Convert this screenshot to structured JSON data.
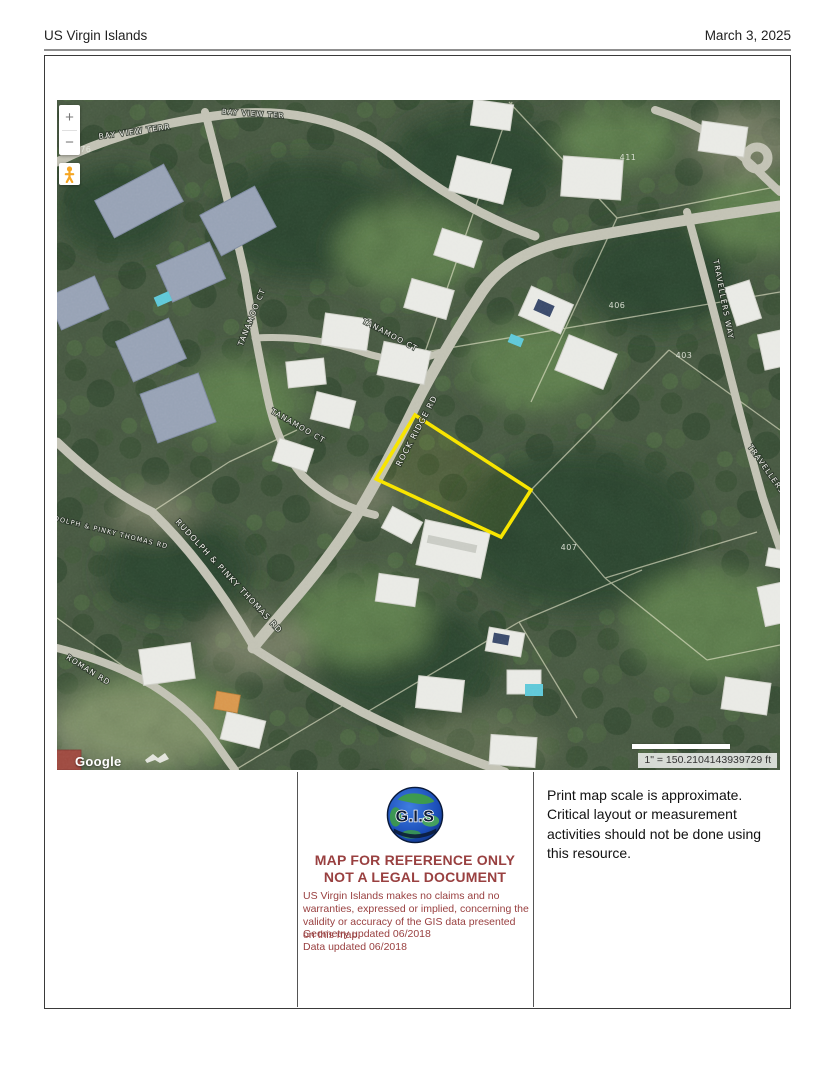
{
  "header": {
    "title": "US Virgin Islands",
    "date": "March 3, 2025"
  },
  "map": {
    "zoom_in_label": "+",
    "zoom_out_label": "−",
    "pegman_icon": "street-view-pegman",
    "attribution": "Google",
    "scale_text": "1\" = 150.2104143939729 ft",
    "highlight_color": "#f8e400",
    "street_labels": [
      {
        "text": "BAY VIEW TERR",
        "x": 78,
        "y": 34,
        "rot": -8,
        "size": 7.5
      },
      {
        "text": "BAY VIEW TER",
        "x": 196,
        "y": 16,
        "rot": 4,
        "size": 7
      },
      {
        "text": "TANAMOO CT",
        "x": 197,
        "y": 218,
        "rot": -68,
        "size": 7.5
      },
      {
        "text": "TANAMOO CT",
        "x": 332,
        "y": 237,
        "rot": 28,
        "size": 7.5
      },
      {
        "text": "TANAMOO CT",
        "x": 240,
        "y": 328,
        "rot": 30,
        "size": 7.5
      },
      {
        "text": "ROCK RIDGE RD",
        "x": 362,
        "y": 332,
        "rot": -62,
        "size": 8
      },
      {
        "text": "RUDOLPH & PINKY THOMAS RD",
        "x": 170,
        "y": 478,
        "rot": 47,
        "size": 8
      },
      {
        "text": "RUDOLPH & PINKY THOMAS RD",
        "x": 48,
        "y": 433,
        "rot": 14,
        "size": 6.5
      },
      {
        "text": "ROMAN RD",
        "x": 30,
        "y": 572,
        "rot": 32,
        "size": 7.5
      },
      {
        "text": "TRAVELLERS WAY",
        "x": 664,
        "y": 200,
        "rot": 79,
        "size": 7.5
      },
      {
        "text": "TRAVELLERS WAY",
        "x": 714,
        "y": 380,
        "rot": 55,
        "size": 7.5
      }
    ],
    "parcel_numbers": [
      {
        "text": "411",
        "x": 571,
        "y": 60
      },
      {
        "text": "406",
        "x": 560,
        "y": 208
      },
      {
        "text": "403",
        "x": 627,
        "y": 258
      },
      {
        "text": "407",
        "x": 512,
        "y": 450
      },
      {
        "text": "476",
        "x": 26,
        "y": 52
      }
    ]
  },
  "footer": {
    "logo_text": "G.I.S",
    "reference_line1": "MAP FOR REFERENCE ONLY",
    "reference_line2": "NOT A LEGAL DOCUMENT",
    "disclaimer": "US Virgin Islands makes no claims and no warranties, expressed or implied, concerning the validity or accuracy of the GIS data presented on this map.",
    "geometry_updated": "Geometry updated 06/2018",
    "data_updated": "Data updated 06/2018",
    "scale_note": "Print map scale is approximate. Critical layout or measurement activities should not be done using this resource."
  },
  "colors": {
    "accent_red": "#994040",
    "parcel_yellow": "#f8e400",
    "globe_blue": "#1a4db8"
  }
}
